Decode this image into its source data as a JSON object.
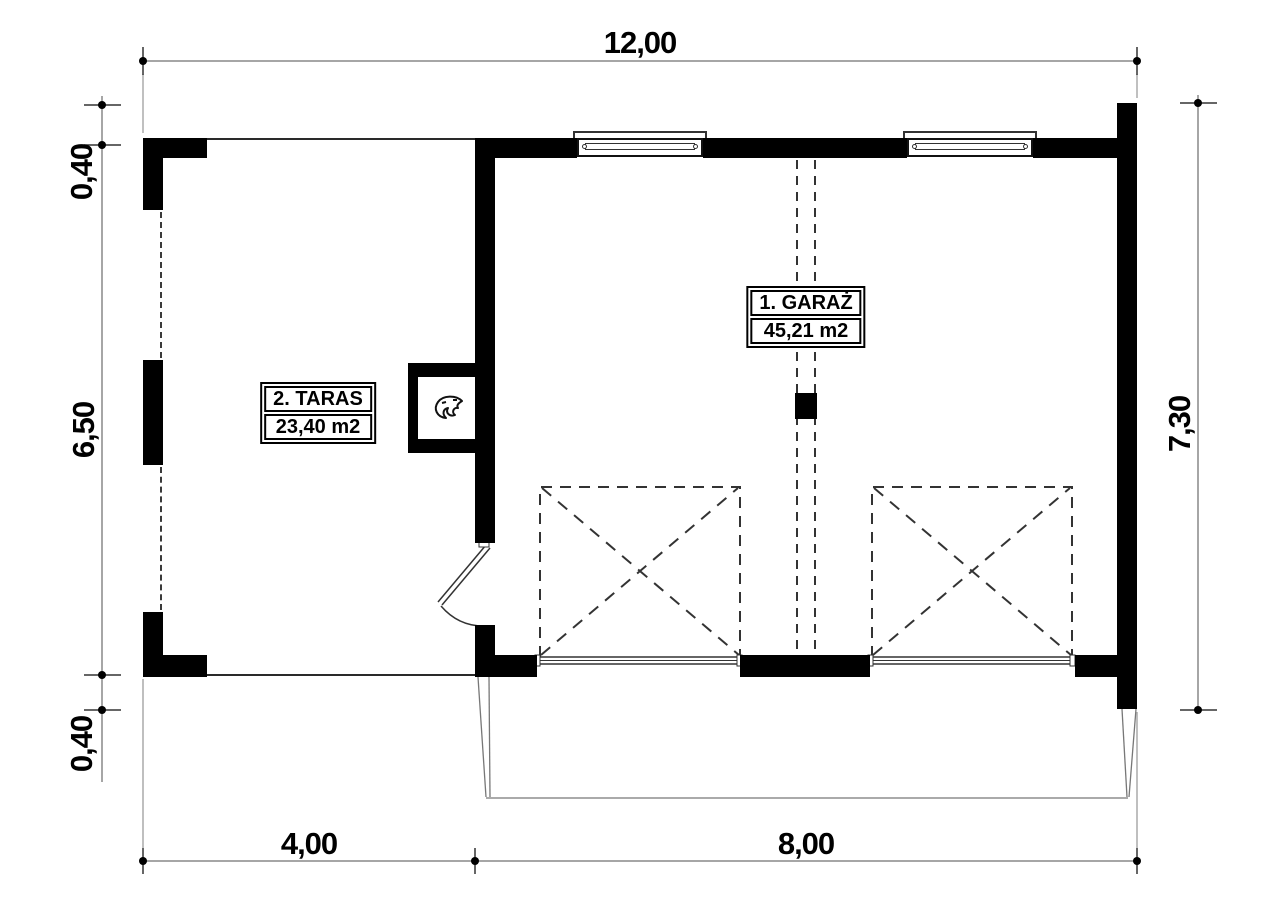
{
  "colors": {
    "wall": "#000000",
    "background": "#ffffff",
    "dimension_line": "#888888"
  },
  "rooms": [
    {
      "name": "1. GARAŻ",
      "area": "45,21 m2"
    },
    {
      "name": "2. TARAS",
      "area": "23,40 m2"
    }
  ],
  "dimensions": {
    "overall_width": "12,00",
    "overall_height": "7,30",
    "left_wall_top": "0,40",
    "left_interior": "6,50",
    "left_wall_bottom": "0,40",
    "terrace_width": "4,00",
    "garage_width": "8,00"
  },
  "icons": {
    "flame": "flame-icon"
  }
}
